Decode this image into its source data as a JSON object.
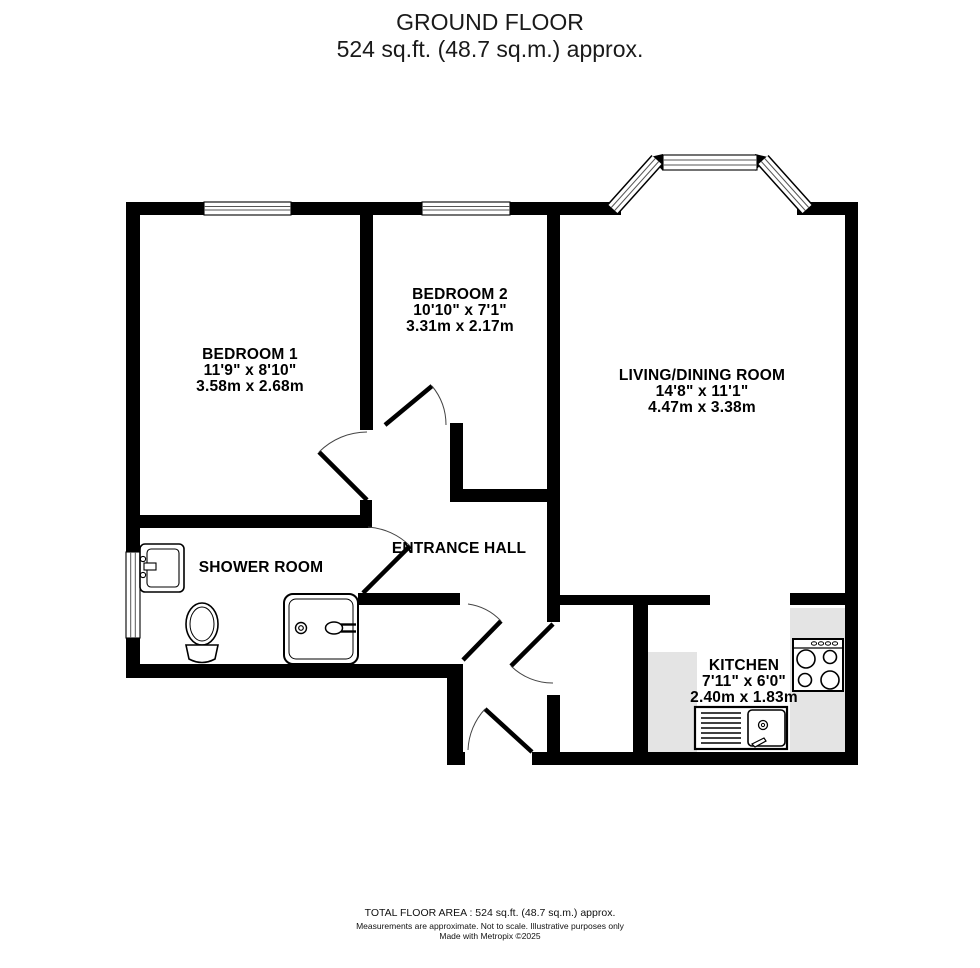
{
  "title": {
    "line1": "GROUND FLOOR",
    "line2": "524 sq.ft. (48.7 sq.m.) approx."
  },
  "rooms": {
    "bedroom1": {
      "name": "BEDROOM 1",
      "imperial": "11'9\"  x 8'10\"",
      "metric": "3.58m  x 2.68m"
    },
    "bedroom2": {
      "name": "BEDROOM 2",
      "imperial": "10'10\"  x 7'1\"",
      "metric": "3.31m  x 2.17m"
    },
    "living": {
      "name": "LIVING/DINING ROOM",
      "imperial": "14'8\"  x 11'1\"",
      "metric": "4.47m  x 3.38m"
    },
    "shower": {
      "name": "SHOWER ROOM"
    },
    "hall": {
      "name": "ENTRANCE HALL"
    },
    "kitchen": {
      "name": "KITCHEN",
      "imperial": "7'11\"  x 6'0\"",
      "metric": "2.40m  x 1.83m"
    }
  },
  "footer": {
    "line1": "TOTAL FLOOR AREA : 524 sq.ft. (48.7 sq.m.) approx.",
    "line2": "Measurements are approximate.  Not to scale.  Illustrative purposes only",
    "line3": "Made with Metropix ©2025"
  },
  "fixtures": [
    "toilet-icon",
    "wash-basin-icon",
    "shower-enclosure-icon",
    "kitchen-sink-icon",
    "hob-icon",
    "worktop-counter"
  ],
  "colors": {
    "wall": "#000000",
    "counter": "#e4e4e4",
    "background": "#ffffff",
    "text": "#000000"
  }
}
